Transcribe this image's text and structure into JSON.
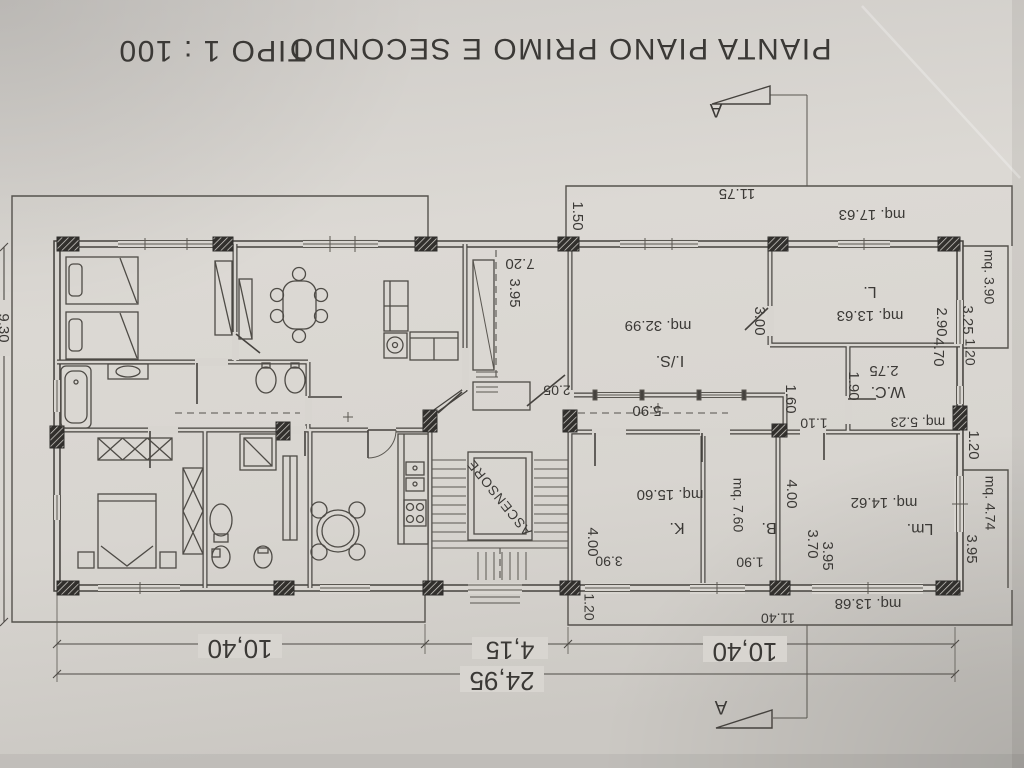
{
  "title": {
    "part1": "PIANTA PIANO PRIMO E SECONDO",
    "part2": "TIPO 1 : 100"
  },
  "section_marks": {
    "top": "A",
    "bottom": "A"
  },
  "overall_dims": {
    "left_wing": "10,40",
    "stair_bay": "4,15",
    "right_wing": "10,40",
    "total": "24,95",
    "left_depth": "9,30"
  },
  "balcony_top": {
    "length": "11.75",
    "area": "mq. 17.63",
    "depth": "1.50"
  },
  "landing": {
    "width": "7.20",
    "depth": "3.95",
    "door_width": "2.05"
  },
  "elevator": {
    "label": "ASCENSORE"
  },
  "soggiorno": {
    "label": "I./S.",
    "area": "mq. 32.99",
    "wall": "3.00"
  },
  "salotto": {
    "label": "L.",
    "area": "mq. 13.63",
    "side": "2.90"
  },
  "balcony_right_top": {
    "area": "mq. 3.90",
    "length": "3.25",
    "depth": "1.20"
  },
  "wc": {
    "label": "W.C.",
    "area": "mq. 5.23",
    "width": "2.75",
    "depth": "1.90",
    "wall": "4.70",
    "door": "1.10",
    "jamb": "1.60"
  },
  "corridor": {
    "length": "5.90"
  },
  "cucina": {
    "label": "K.",
    "area": "mq. 15.60",
    "depth": "4.00",
    "window": "3.90"
  },
  "bagno": {
    "label": "B.",
    "area": "mq. 7.60",
    "depth": "4.00",
    "window": "1.90"
  },
  "camera": {
    "label": "Lm.",
    "area": "mq. 14.62",
    "d1": "3.70",
    "d2": "3.95"
  },
  "balcony_right_bottom": {
    "area": "mq. 4.74",
    "length": "3.95",
    "depth": "1.20",
    "offset": "1.20"
  },
  "balcony_bottom": {
    "area": "mq. 13.68",
    "length": "11.40",
    "depth": "1.20"
  }
}
